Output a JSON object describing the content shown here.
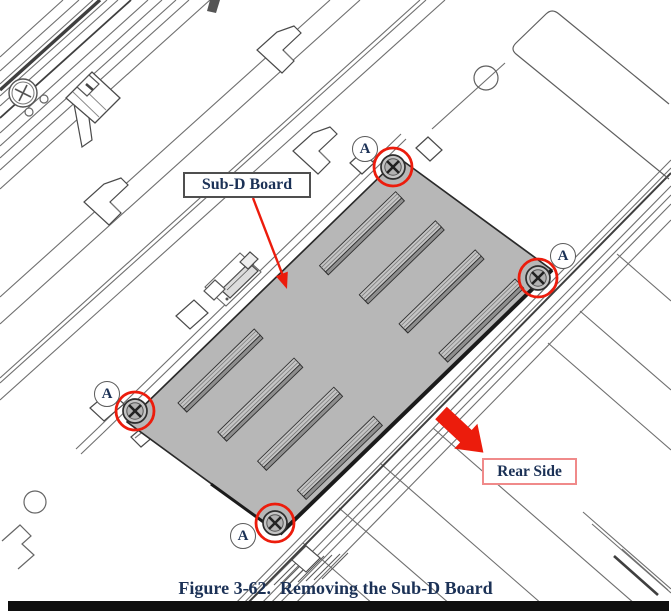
{
  "figure": {
    "caption": "Figure 3-62.  Removing the Sub-D Board",
    "labels": {
      "board": "Sub-D Board",
      "rear": "Rear Side",
      "screw": "A"
    },
    "screw_callout_count": 4,
    "colors": {
      "highlight_red": "#ec1c0c",
      "label_text": "#1b3156",
      "board_gray": "#b7b7b7",
      "rear_border": "#f08a8a"
    }
  }
}
